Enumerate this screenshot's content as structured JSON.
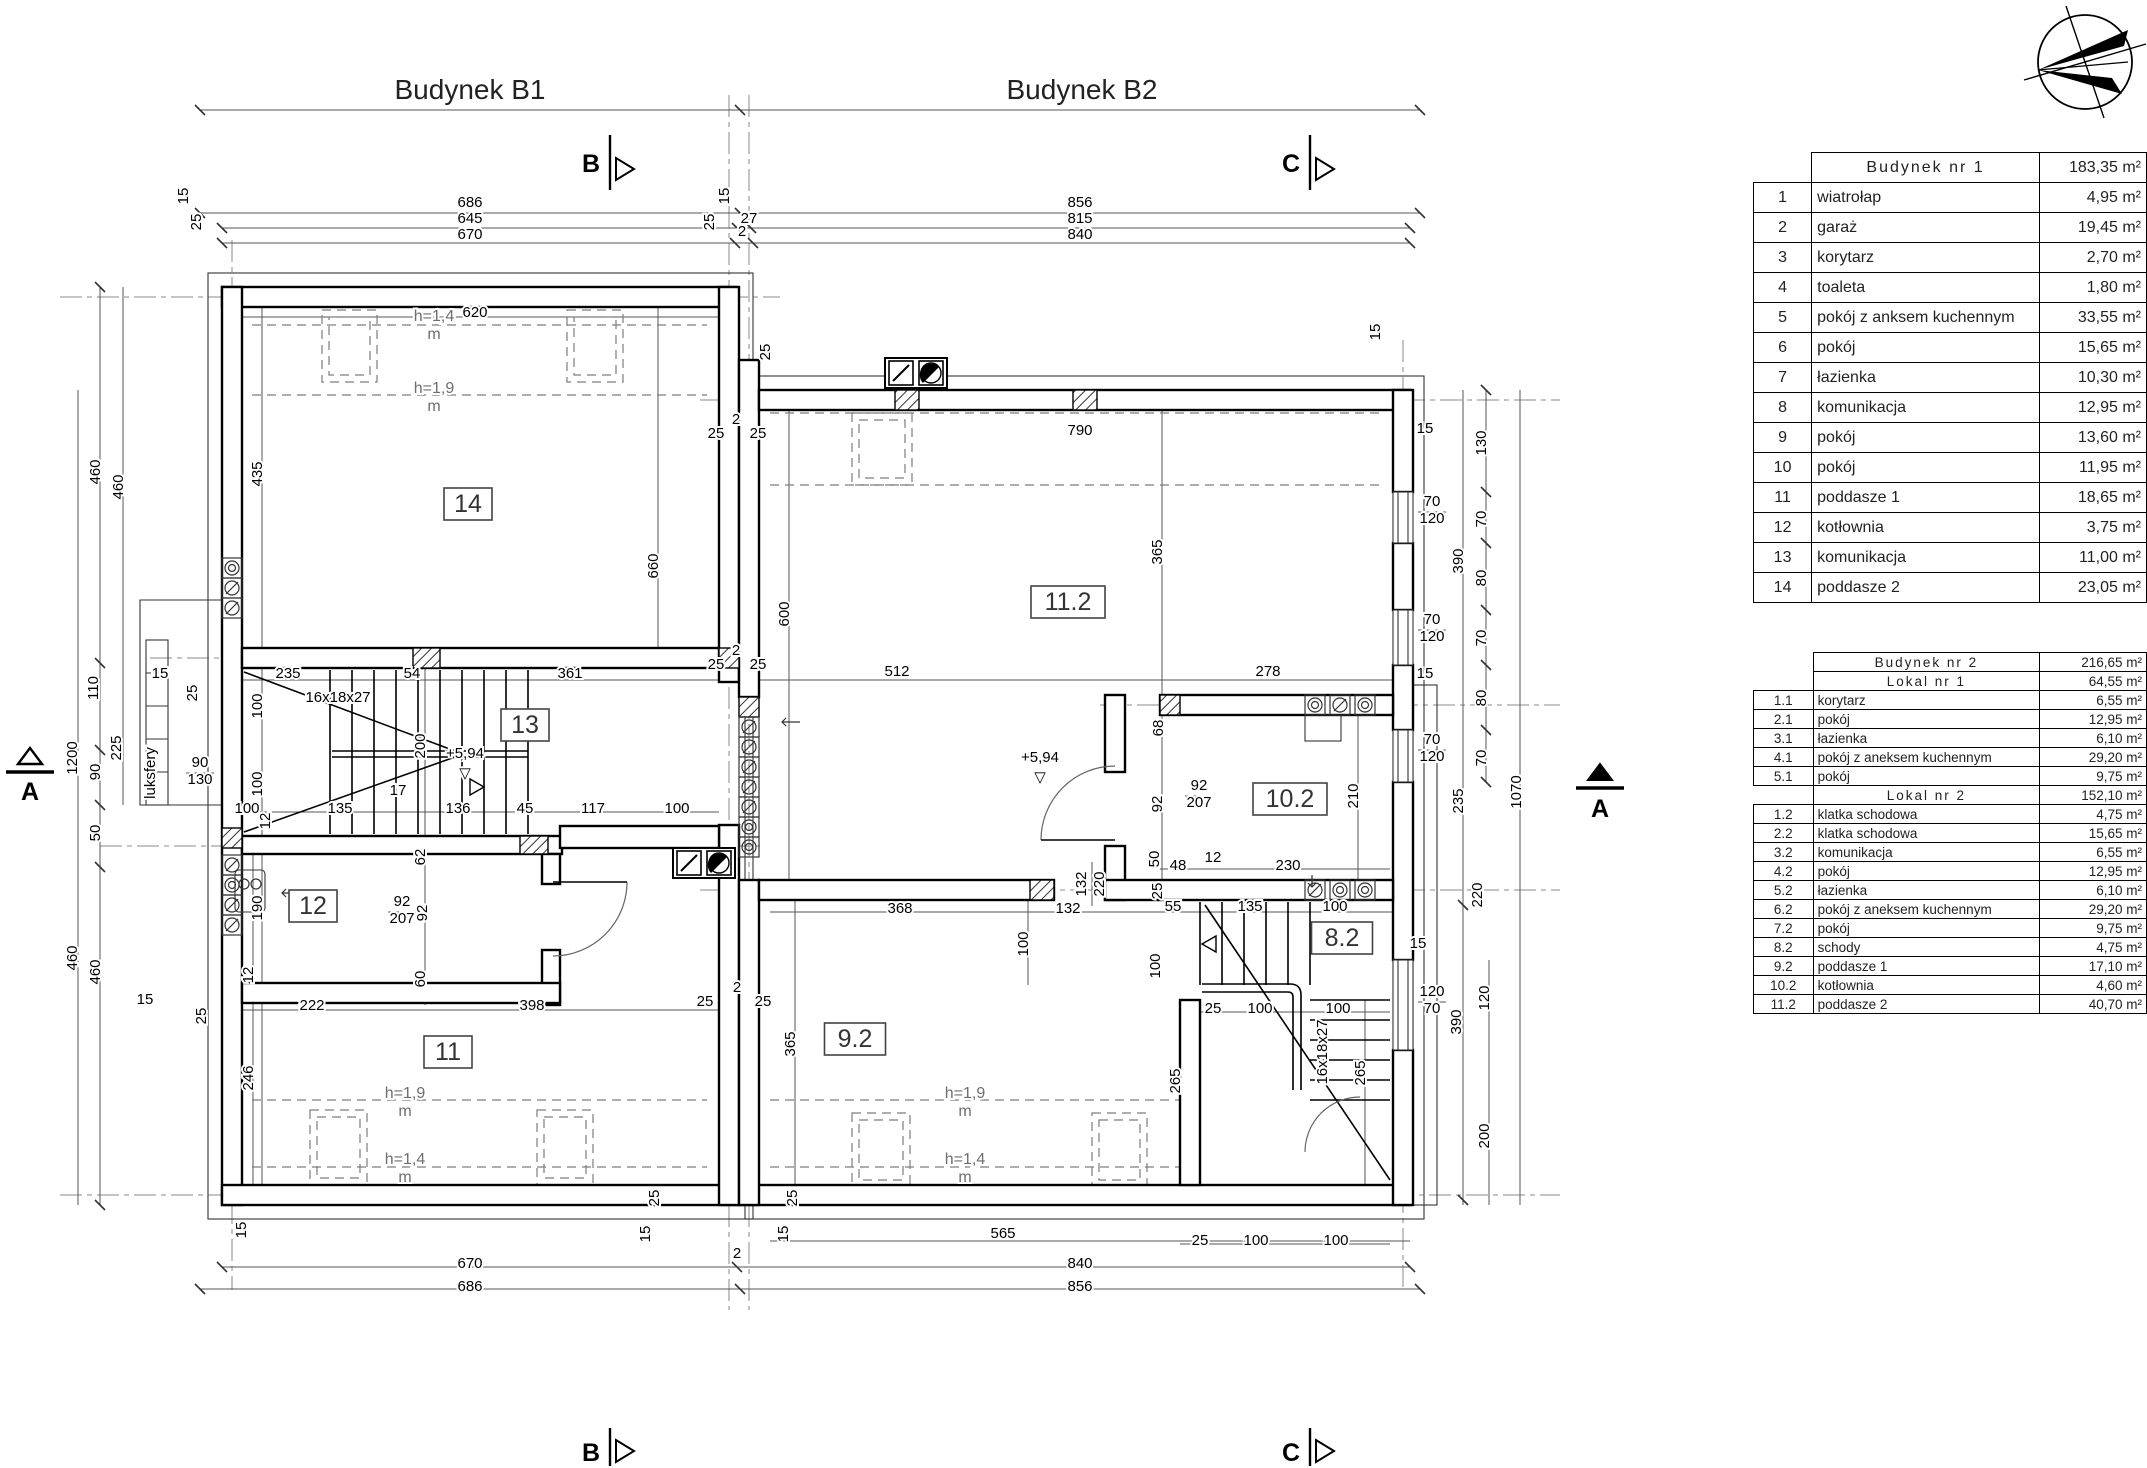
{
  "header": {
    "building1": "Budynek B1",
    "building2": "Budynek B2"
  },
  "tables": {
    "t1": {
      "title": "Budynek nr 1",
      "total": "183,35 m²",
      "rows": [
        [
          "1",
          "wiatrołap",
          "4,95 m²"
        ],
        [
          "2",
          "garaż",
          "19,45 m²"
        ],
        [
          "3",
          "korytarz",
          "2,70 m²"
        ],
        [
          "4",
          "toaleta",
          "1,80 m²"
        ],
        [
          "5",
          "pokój z anksem kuchennym",
          "33,55 m²"
        ],
        [
          "6",
          "pokój",
          "15,65 m²"
        ],
        [
          "7",
          "łazienka",
          "10,30 m²"
        ],
        [
          "8",
          "komunikacja",
          "12,95 m²"
        ],
        [
          "9",
          "pokój",
          "13,60 m²"
        ],
        [
          "10",
          "pokój",
          "11,95 m²"
        ],
        [
          "11",
          "poddasze 1",
          "18,65 m²"
        ],
        [
          "12",
          "kotłownia",
          "3,75 m²"
        ],
        [
          "13",
          "komunikacja",
          "11,00 m²"
        ],
        [
          "14",
          "poddasze 2",
          "23,05 m²"
        ]
      ]
    },
    "t2": {
      "title": "Budynek nr 2",
      "total": "216,65 m²",
      "sections": [
        {
          "title": "Lokal nr 1",
          "total": "64,55 m²",
          "rows": [
            [
              "1.1",
              "korytarz",
              "6,55 m²"
            ],
            [
              "2.1",
              "pokój",
              "12,95 m²"
            ],
            [
              "3.1",
              "łazienka",
              "6,10 m²"
            ],
            [
              "4.1",
              "pokój z aneksem kuchennym",
              "29,20 m²"
            ],
            [
              "5.1",
              "pokój",
              "9,75 m²"
            ]
          ]
        },
        {
          "title": "Lokal nr 2",
          "total": "152,10 m²",
          "rows": [
            [
              "1.2",
              "klatka schodowa",
              "4,75 m²"
            ],
            [
              "2.2",
              "klatka schodowa",
              "15,65 m²"
            ],
            [
              "3.2",
              "komunikacja",
              "6,55 m²"
            ],
            [
              "4.2",
              "pokój",
              "12,95 m²"
            ],
            [
              "5.2",
              "łazienka",
              "6,10 m²"
            ],
            [
              "6.2",
              "pokój z aneksem kuchennym",
              "29,20 m²"
            ],
            [
              "7.2",
              "pokój",
              "9,75 m²"
            ],
            [
              "8.2",
              "schody",
              "4,75 m²"
            ],
            [
              "9.2",
              "poddasze 1",
              "17,10 m²"
            ],
            [
              "10.2",
              "kotłownia",
              "4,60 m²"
            ],
            [
              "11.2",
              "poddasze 2",
              "40,70 m²"
            ]
          ]
        }
      ]
    }
  },
  "plan": {
    "rooms": [
      {
        "t": "14",
        "x": 468,
        "y": 505
      },
      {
        "t": "13",
        "x": 525,
        "y": 726
      },
      {
        "t": "12",
        "x": 313,
        "y": 907
      },
      {
        "t": "11",
        "x": 448,
        "y": 1053
      },
      {
        "t": "11.2",
        "x": 1068,
        "y": 603
      },
      {
        "t": "10.2",
        "x": 1290,
        "y": 800
      },
      {
        "t": "9.2",
        "x": 855,
        "y": 1040
      },
      {
        "t": "8.2",
        "x": 1342,
        "y": 939
      }
    ],
    "dims": [
      {
        "t": "686",
        "x": 470,
        "y": 207
      },
      {
        "t": "645",
        "x": 470,
        "y": 223
      },
      {
        "t": "670",
        "x": 470,
        "y": 239
      },
      {
        "t": "856",
        "x": 1080,
        "y": 207
      },
      {
        "t": "815",
        "x": 1080,
        "y": 223
      },
      {
        "t": "840",
        "x": 1080,
        "y": 239
      },
      {
        "t": "27",
        "x": 749,
        "y": 223
      },
      {
        "t": "2",
        "x": 742,
        "y": 236
      },
      {
        "t": "15",
        "x": 188,
        "y": 196,
        "r": -90
      },
      {
        "t": "25",
        "x": 201,
        "y": 222,
        "r": -90
      },
      {
        "t": "15",
        "x": 729,
        "y": 196,
        "r": -90
      },
      {
        "t": "25",
        "x": 714,
        "y": 222,
        "r": -90
      },
      {
        "t": "25",
        "x": 770,
        "y": 352,
        "r": -90
      },
      {
        "t": "15",
        "x": 1380,
        "y": 332,
        "r": -90
      },
      {
        "t": "2",
        "x": 736,
        "y": 424
      },
      {
        "t": "25",
        "x": 716,
        "y": 438
      },
      {
        "t": "25",
        "x": 758,
        "y": 438
      },
      {
        "t": "2",
        "x": 736,
        "y": 655
      },
      {
        "t": "25",
        "x": 716,
        "y": 669
      },
      {
        "t": "25",
        "x": 758,
        "y": 669
      },
      {
        "t": "2",
        "x": 737,
        "y": 992
      },
      {
        "t": "25",
        "x": 705,
        "y": 1006
      },
      {
        "t": "25",
        "x": 763,
        "y": 1006
      },
      {
        "t": "460",
        "x": 100,
        "y": 472,
        "r": -90
      },
      {
        "t": "460",
        "x": 123,
        "y": 487,
        "r": -90
      },
      {
        "t": "110",
        "x": 98,
        "y": 688,
        "r": -90
      },
      {
        "t": "225",
        "x": 121,
        "y": 748,
        "r": -90
      },
      {
        "t": "90",
        "x": 100,
        "y": 772,
        "r": -90
      },
      {
        "t": "1200",
        "x": 77,
        "y": 758,
        "r": -90
      },
      {
        "t": "50",
        "x": 100,
        "y": 833,
        "r": -90
      },
      {
        "t": "460",
        "x": 77,
        "y": 958,
        "r": -90
      },
      {
        "t": "460",
        "x": 100,
        "y": 972,
        "r": -90
      },
      {
        "t": "15",
        "x": 160,
        "y": 678
      },
      {
        "t": "25",
        "x": 197,
        "y": 693,
        "r": -90
      },
      {
        "t": "15",
        "x": 145,
        "y": 1004
      },
      {
        "t": "25",
        "x": 206,
        "y": 1016,
        "r": -90
      },
      {
        "t": "15",
        "x": 246,
        "y": 1230,
        "r": -90
      },
      {
        "t": "670",
        "x": 470,
        "y": 1268
      },
      {
        "t": "686",
        "x": 470,
        "y": 1291
      },
      {
        "t": "840",
        "x": 1080,
        "y": 1268
      },
      {
        "t": "856",
        "x": 1080,
        "y": 1291
      },
      {
        "t": "2",
        "x": 737,
        "y": 1258
      },
      {
        "t": "25",
        "x": 659,
        "y": 1198,
        "r": -90
      },
      {
        "t": "15",
        "x": 650,
        "y": 1234,
        "r": -90
      },
      {
        "t": "25",
        "x": 797,
        "y": 1198,
        "r": -90
      },
      {
        "t": "15",
        "x": 788,
        "y": 1234,
        "r": -90
      },
      {
        "t": "15",
        "x": 1425,
        "y": 433
      },
      {
        "t": "130",
        "x": 1486,
        "y": 443,
        "r": -90
      },
      {
        "t": "70",
        "x": 1486,
        "y": 519,
        "r": -90
      },
      {
        "t": "390",
        "x": 1463,
        "y": 561,
        "r": -90
      },
      {
        "t": "80",
        "x": 1486,
        "y": 578,
        "r": -90
      },
      {
        "t": "70",
        "x": 1486,
        "y": 638,
        "r": -90
      },
      {
        "t": "80",
        "x": 1486,
        "y": 698,
        "r": -90
      },
      {
        "t": "15",
        "x": 1425,
        "y": 678
      },
      {
        "t": "70",
        "x": 1486,
        "y": 758,
        "r": -90
      },
      {
        "t": "235",
        "x": 1463,
        "y": 801,
        "r": -90
      },
      {
        "t": "220",
        "x": 1482,
        "y": 895,
        "r": -90
      },
      {
        "t": "390",
        "x": 1461,
        "y": 1022,
        "r": -90
      },
      {
        "t": "120",
        "x": 1489,
        "y": 998,
        "r": -90
      },
      {
        "t": "200",
        "x": 1489,
        "y": 1136,
        "r": -90
      },
      {
        "t": "1070",
        "x": 1521,
        "y": 792,
        "r": -90
      },
      {
        "t": "15",
        "x": 1418,
        "y": 948
      },
      {
        "t": "70",
        "x": 1432,
        "y": 506
      },
      {
        "t": "120",
        "x": 1432,
        "y": 523
      },
      {
        "t": "70",
        "x": 1432,
        "y": 624
      },
      {
        "t": "120",
        "x": 1432,
        "y": 641
      },
      {
        "t": "70",
        "x": 1432,
        "y": 744
      },
      {
        "t": "120",
        "x": 1432,
        "y": 761
      },
      {
        "t": "120",
        "x": 1432,
        "y": 996
      },
      {
        "t": "70",
        "x": 1432,
        "y": 1013
      },
      {
        "t": "620",
        "x": 475,
        "y": 317
      },
      {
        "t": "435",
        "x": 262,
        "y": 474,
        "r": -90
      },
      {
        "t": "660",
        "x": 658,
        "y": 566,
        "r": -90
      },
      {
        "t": "600",
        "x": 789,
        "y": 614,
        "r": -90
      },
      {
        "t": "235",
        "x": 288,
        "y": 678
      },
      {
        "t": "54",
        "x": 412,
        "y": 678
      },
      {
        "t": "361",
        "x": 570,
        "y": 678
      },
      {
        "t": "100",
        "x": 262,
        "y": 706,
        "r": -90
      },
      {
        "t": "200",
        "x": 425,
        "y": 746,
        "r": -90
      },
      {
        "t": "100",
        "x": 262,
        "y": 784,
        "r": -90
      },
      {
        "t": "100",
        "x": 247,
        "y": 813
      },
      {
        "t": "135",
        "x": 340,
        "y": 813
      },
      {
        "t": "17",
        "x": 398,
        "y": 795
      },
      {
        "t": "136",
        "x": 458,
        "y": 813
      },
      {
        "t": "45",
        "x": 525,
        "y": 813
      },
      {
        "t": "117",
        "x": 593,
        "y": 813
      },
      {
        "t": "100",
        "x": 677,
        "y": 813
      },
      {
        "t": "12",
        "x": 270,
        "y": 821,
        "r": -90
      },
      {
        "t": "62",
        "x": 425,
        "y": 857,
        "r": -90
      },
      {
        "t": "92",
        "x": 427,
        "y": 913,
        "r": -90
      },
      {
        "t": "92",
        "x": 402,
        "y": 906
      },
      {
        "t": "207",
        "x": 402,
        "y": 923
      },
      {
        "t": "190",
        "x": 262,
        "y": 908,
        "r": -90
      },
      {
        "t": "12",
        "x": 253,
        "y": 975,
        "r": -90
      },
      {
        "t": "60",
        "x": 425,
        "y": 979,
        "r": -90
      },
      {
        "t": "222",
        "x": 312,
        "y": 1010
      },
      {
        "t": "398",
        "x": 532,
        "y": 1010
      },
      {
        "t": "246",
        "x": 253,
        "y": 1078,
        "r": -90
      },
      {
        "t": "790",
        "x": 1080,
        "y": 435
      },
      {
        "t": "365",
        "x": 1162,
        "y": 552,
        "r": -90
      },
      {
        "t": "512",
        "x": 897,
        "y": 676
      },
      {
        "t": "278",
        "x": 1268,
        "y": 676
      },
      {
        "t": "68",
        "x": 1163,
        "y": 728,
        "r": -90
      },
      {
        "t": "92",
        "x": 1162,
        "y": 804,
        "r": -90
      },
      {
        "t": "92",
        "x": 1199,
        "y": 790
      },
      {
        "t": "207",
        "x": 1199,
        "y": 807
      },
      {
        "t": "50",
        "x": 1159,
        "y": 859,
        "r": -90
      },
      {
        "t": "48",
        "x": 1178,
        "y": 870
      },
      {
        "t": "12",
        "x": 1213,
        "y": 862
      },
      {
        "t": "230",
        "x": 1288,
        "y": 870
      },
      {
        "t": "210",
        "x": 1358,
        "y": 796,
        "r": -90
      },
      {
        "t": "25",
        "x": 1162,
        "y": 891,
        "r": -90
      },
      {
        "t": "368",
        "x": 900,
        "y": 913
      },
      {
        "t": "132",
        "x": 1068,
        "y": 913
      },
      {
        "t": "55",
        "x": 1173,
        "y": 911
      },
      {
        "t": "135",
        "x": 1250,
        "y": 911
      },
      {
        "t": "100",
        "x": 1335,
        "y": 911
      },
      {
        "t": "132",
        "x": 1086,
        "y": 884,
        "r": -90
      },
      {
        "t": "220",
        "x": 1104,
        "y": 884,
        "r": -90
      },
      {
        "t": "365",
        "x": 795,
        "y": 1044,
        "r": -90
      },
      {
        "t": "565",
        "x": 1003,
        "y": 1238
      },
      {
        "t": "265",
        "x": 1180,
        "y": 1081,
        "r": -90
      },
      {
        "t": "265",
        "x": 1365,
        "y": 1073,
        "r": -90
      },
      {
        "t": "100",
        "x": 1028,
        "y": 944,
        "r": -90
      },
      {
        "t": "100",
        "x": 1160,
        "y": 966,
        "r": -90
      },
      {
        "t": "25",
        "x": 1213,
        "y": 1013
      },
      {
        "t": "100",
        "x": 1260,
        "y": 1013
      },
      {
        "t": "100",
        "x": 1338,
        "y": 1013
      },
      {
        "t": "25",
        "x": 1200,
        "y": 1245
      },
      {
        "t": "100",
        "x": 1256,
        "y": 1245
      },
      {
        "t": "100",
        "x": 1336,
        "y": 1245
      },
      {
        "t": "90",
        "x": 200,
        "y": 767
      },
      {
        "t": "130",
        "x": 200,
        "y": 784
      }
    ],
    "notes": [
      {
        "t": "Budynek B1",
        "x": 470,
        "y": 99,
        "c": "title"
      },
      {
        "t": "Budynek B2",
        "x": 1082,
        "y": 99,
        "c": "title"
      },
      {
        "t": "B",
        "x": 591,
        "y": 172,
        "c": "big"
      },
      {
        "t": "C",
        "x": 1291,
        "y": 172,
        "c": "big"
      },
      {
        "t": "B",
        "x": 591,
        "y": 1461,
        "c": "big"
      },
      {
        "t": "C",
        "x": 1291,
        "y": 1461,
        "c": "big"
      },
      {
        "t": "A",
        "x": 30,
        "y": 800,
        "c": "big"
      },
      {
        "t": "A",
        "x": 1600,
        "y": 817,
        "c": "big"
      },
      {
        "t": "16x18x27",
        "x": 338,
        "y": 702
      },
      {
        "t": "16x18x27",
        "x": 1327,
        "y": 1052,
        "r": -90
      },
      {
        "t": "+5,94",
        "x": 465,
        "y": 758
      },
      {
        "t": "▽",
        "x": 465,
        "y": 778
      },
      {
        "t": "+5,94",
        "x": 1040,
        "y": 762
      },
      {
        "t": "▽",
        "x": 1040,
        "y": 782
      },
      {
        "t": "h=1,4",
        "x": 434,
        "y": 321,
        "c": "grey"
      },
      {
        "t": "m",
        "x": 434,
        "y": 339,
        "c": "grey"
      },
      {
        "t": "h=1,9",
        "x": 434,
        "y": 393,
        "c": "grey"
      },
      {
        "t": "m",
        "x": 434,
        "y": 411,
        "c": "grey"
      },
      {
        "t": "h=1,9",
        "x": 405,
        "y": 1098,
        "c": "grey"
      },
      {
        "t": "m",
        "x": 405,
        "y": 1116,
        "c": "grey"
      },
      {
        "t": "h=1,4",
        "x": 405,
        "y": 1164,
        "c": "grey"
      },
      {
        "t": "m",
        "x": 405,
        "y": 1182,
        "c": "grey"
      },
      {
        "t": "h=1,9",
        "x": 965,
        "y": 1098,
        "c": "grey"
      },
      {
        "t": "m",
        "x": 965,
        "y": 1116,
        "c": "grey"
      },
      {
        "t": "h=1,4",
        "x": 965,
        "y": 1164,
        "c": "grey"
      },
      {
        "t": "m",
        "x": 965,
        "y": 1182,
        "c": "grey"
      },
      {
        "t": "luksfery",
        "x": 155,
        "y": 773,
        "r": -90
      }
    ]
  }
}
